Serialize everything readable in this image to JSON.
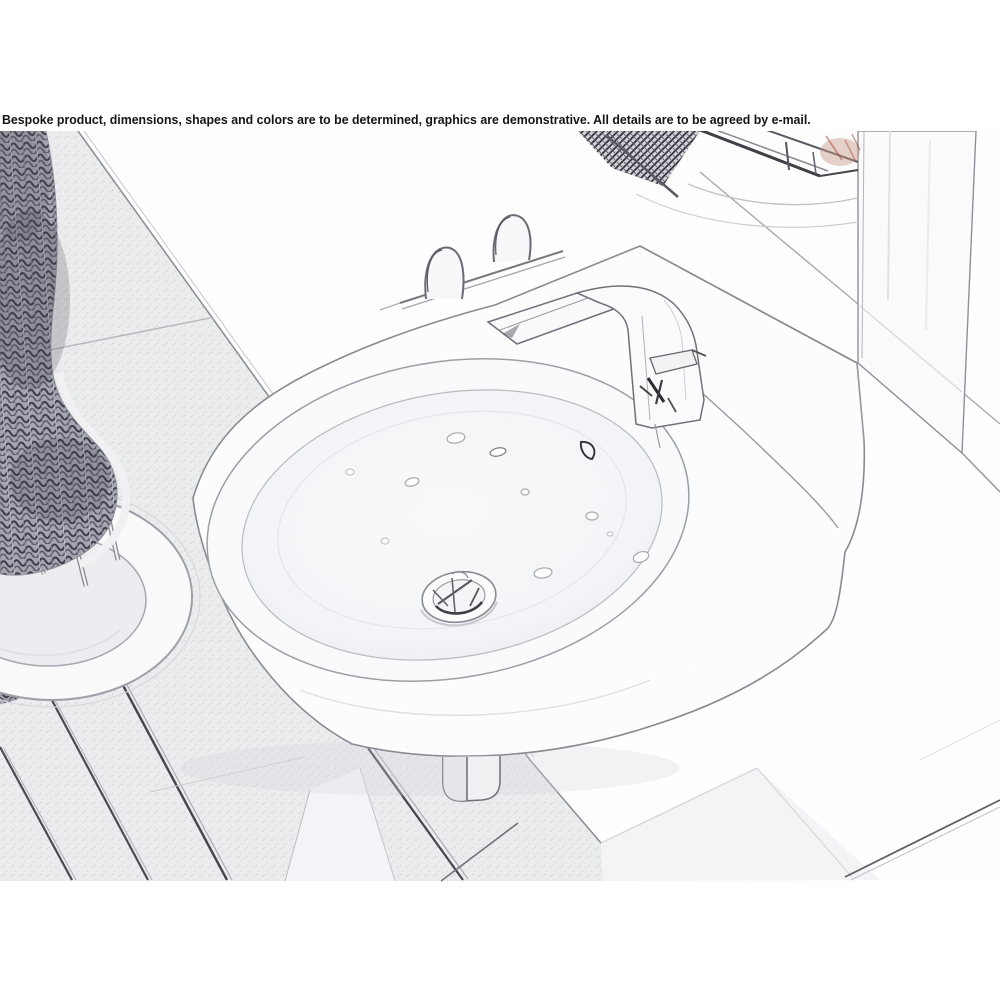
{
  "banner": {
    "text": "Bespoke product, dimensions, shapes and colors are to be determined, graphics are demonstrative. All details are to be agreed by e-mail."
  },
  "scene": {
    "type": "pencil-sketch product render",
    "objects": [
      "wicker-chair",
      "chair-ring-base",
      "wood-plank-floor",
      "wall-hung-oval-washbasin",
      "angular-single-lever-faucet",
      "pop-up-drain",
      "towel-hooks",
      "wall-rail",
      "mirror-glass-panel",
      "wall-shelf-with-items",
      "mounting-bracket"
    ]
  },
  "colors": {
    "background": "#ffffff",
    "text": "#141414",
    "sketch_line": "#8a8a92",
    "dark_line": "#3c3c46",
    "floor_fill": "#ecedef",
    "weave_dark": "#3a3a46",
    "warm_accent": "#b5826e",
    "red_accent": "#a84838"
  }
}
